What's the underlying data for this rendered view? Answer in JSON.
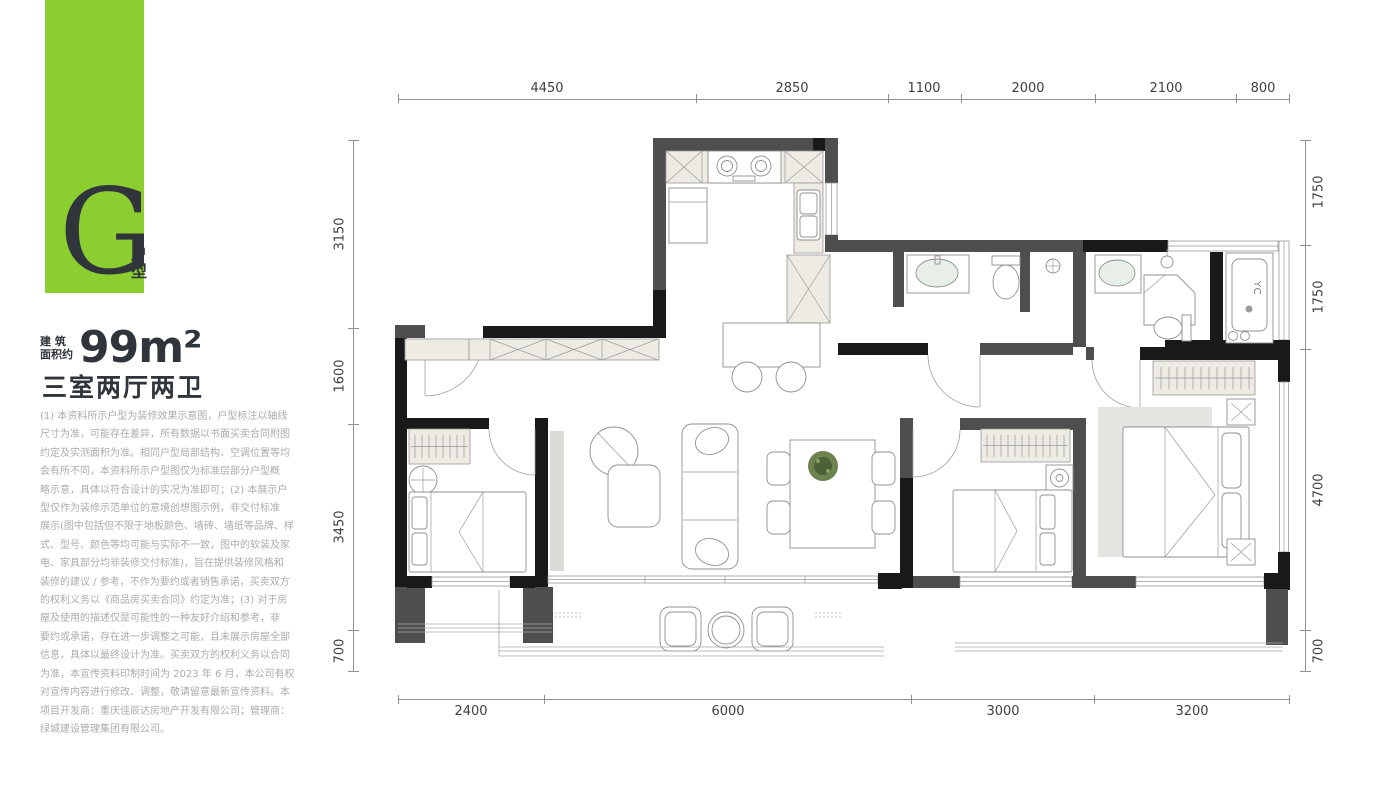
{
  "badge": {
    "letter": "G",
    "type_label": "户型",
    "bg_color": "#8ccd2f"
  },
  "area": {
    "label": "建 筑\n面积约",
    "value": "99m²"
  },
  "title": "三室两厅两卫",
  "disclaimer": "(1) 本资料所示户型为装修效果示意图，户型标注以轴线\n尺寸为准，可能存在差异，所有数据以书面买卖合同附图\n约定及实测面积为准。相同户型局部结构、空调位置等均\n会有所不同，本资料所示户型图仅为标准层部分户型概\n略示意，具体以符合设计的实况为准即可；(2) 本展示户\n型仅作为装修示范单位的意境创想图示例，非交付标准\n展示(图中包括但不限于地板颜色、墙砖、墙纸等品牌、样\n式、型号、颜色等均可能与实际不一致，图中的软装及家\n电、家具部分均非装修交付标准)，旨在提供装修风格和\n装修的建议 / 参考，不作为要约或者销售承诺，买卖双方\n的权利义务以《商品房买卖合同》约定为准；(3) 对于房\n屋及使用的描述仅是可能性的一种友好介绍和参考，非\n要约或承诺，存在进一步调整之可能，且未展示房屋全部\n信息，具体以最终设计为准。买卖双方的权利义务以合同\n为准，本宣传资料印制时间为 2023 年 6 月，本公司有权\n对宣传内容进行修改、调整，敬请留意最新宣传资料。本\n项目开发商：重庆佳辰达房地产开发有限公司；管理商：\n绿城建设管理集团有限公司。",
  "dims": {
    "top": [
      "4450",
      "2850",
      "1100",
      "2000",
      "2100",
      "800"
    ],
    "bottom": [
      "2400",
      "6000",
      "3000",
      "3200"
    ],
    "left": [
      "3150",
      "1600",
      "3450",
      "700"
    ],
    "right": [
      "1750",
      "1750",
      "4700",
      "700"
    ]
  },
  "plan": {
    "washer_label": "YC"
  },
  "colors": {
    "badge_green": "#8ccd2f",
    "wall_dark": "#191919",
    "wall_gray": "#4e4e4e"
  }
}
